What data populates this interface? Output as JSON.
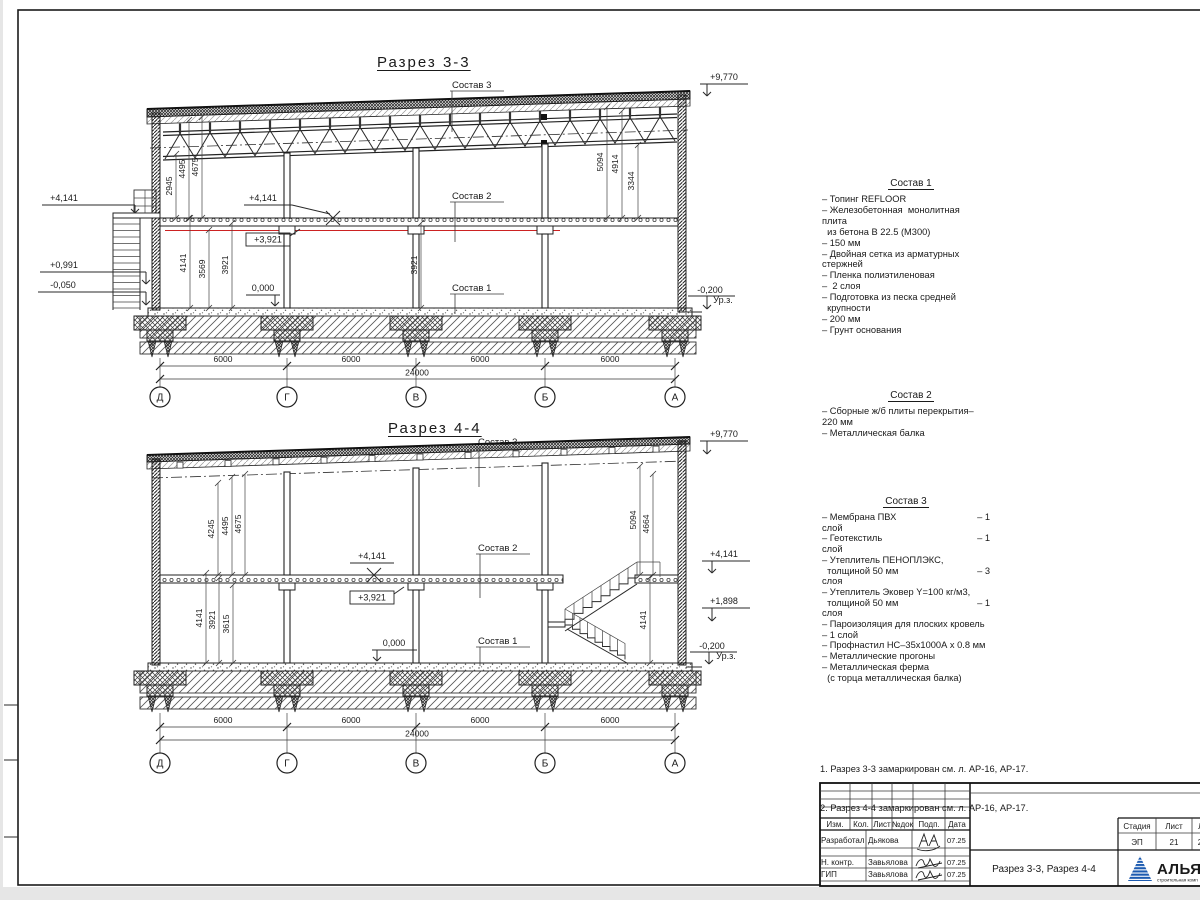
{
  "page": {
    "canvas_bg": "#e6e6e6",
    "sheet_bg": "#ffffff",
    "line_color": "#2a2a2a",
    "red_line_color": "#cc2222",
    "logo_blue": "#1d5bb0",
    "logo_text_blue": "#16357f",
    "logo_red": "#cf3a3a"
  },
  "s33": {
    "title": "Разрез 3-3",
    "sostav3_label": "Состав 3",
    "sostav2_label": "Состав 2",
    "sostav1_label": "Состав 1",
    "elev_roof": "+9,770",
    "elev_platform": "+4,141",
    "elev_stair_mid": "+0,991",
    "elev_stair_base": "-0,050",
    "elev_slab": "+4,141",
    "elev_beam": "+3,921",
    "elev_floor": "0,000",
    "elev_ground": "-0,200",
    "ground_suffix": "Ур.з.",
    "dim_left_up": [
      "2945",
      "4495",
      "4675"
    ],
    "dim_left_low": [
      "4141",
      "3569",
      "3921"
    ],
    "dim_mid": "3921",
    "dim_right": [
      "5094",
      "4914",
      "3344"
    ],
    "dim_span": "6000",
    "dim_total": "24000",
    "axes": [
      "Д",
      "Г",
      "В",
      "Б",
      "А"
    ]
  },
  "s44": {
    "title": "Разрез 4-4",
    "sostav3_label": "Состав 3",
    "sostav2_label": "Состав 2",
    "sostav1_label": "Состав 1",
    "elev_roof": "+9,770",
    "elev_slab": "+4,141",
    "elev_beam": "+3,921",
    "elev_floor": "0,000",
    "elev_slab_right": "+4,141",
    "elev_landing": "+1,898",
    "elev_ground": "-0,200",
    "ground_suffix": "Ур.з.",
    "dim_left_up": [
      "4245",
      "4495",
      "4675"
    ],
    "dim_left_low": [
      "4141",
      "3921",
      "3615"
    ],
    "dim_right": [
      "5094",
      "4664"
    ],
    "dim_stair": "4141",
    "dim_span": "6000",
    "dim_total": "24000",
    "axes": [
      "Д",
      "Г",
      "В",
      "Б",
      "А"
    ]
  },
  "sostav1": {
    "title": "Состав 1",
    "lines": [
      "– Топинг REFLOOR",
      "– Железобетонная  монолитная",
      "плита",
      "  из бетона В 22.5 (М300)",
      "– 150 мм",
      "– Двойная сетка из арматурных",
      "стержней",
      "– Пленка полиэтиленовая",
      "–  2 слоя",
      "– Подготовка из песка средней",
      "  крупности",
      "– 200 мм",
      "– Грунт основания"
    ]
  },
  "sostav2": {
    "title": "Состав 2",
    "lines": [
      "– Сборные ж/б плиты перекрытия–",
      "220 мм",
      "– Металлическая балка"
    ]
  },
  "sostav3": {
    "title": "Состав 3",
    "rows": [
      {
        "t": "– Мембрана ПВХ",
        "r": "– 1"
      },
      {
        "t": "слой",
        "r": ""
      },
      {
        "t": "– Геотекстиль",
        "r": "– 1"
      },
      {
        "t": "слой",
        "r": ""
      },
      {
        "t": "– Утеплитель ПЕНОПЛЭКС,",
        "r": ""
      },
      {
        "t": "  толщиной 50 мм",
        "r": "– 3"
      },
      {
        "t": "слоя",
        "r": ""
      },
      {
        "t": "– Утеплитель Эковер Y=100 кг/м3,",
        "r": ""
      },
      {
        "t": "  толщиной 50 мм",
        "r": "– 1"
      },
      {
        "t": "слоя",
        "r": ""
      },
      {
        "t": "– Пароизоляция для плоских кровель",
        "r": ""
      },
      {
        "t": "– 1 слой",
        "r": ""
      },
      {
        "t": "– Профнастил НС–35х1000А х 0.8 мм",
        "r": ""
      },
      {
        "t": "– Металлические прогоны",
        "r": ""
      },
      {
        "t": "– Металлическая ферма",
        "r": ""
      },
      {
        "t": "  (с торца металлическая балка)",
        "r": ""
      }
    ]
  },
  "notes": {
    "n1": "1. Разрез 3-3 замаркирован см. л. АР-16, АР-17.",
    "n2": "2. Разрез 4-4 замаркирован см. л. АР-16, АР-17."
  },
  "tb": {
    "headers": [
      "Изм.",
      "Кол.",
      "Лист",
      "№док",
      "Подп.",
      "Дата"
    ],
    "rows": [
      {
        "role": "Разработал",
        "name": "Дьякова",
        "date": "07.25"
      },
      {
        "role": "Н. контр.",
        "name": "Завьялова",
        "date": "07.25"
      },
      {
        "role": "ГИП",
        "name": "Завьялова",
        "date": "07.25"
      }
    ],
    "stage_header": "Стадия",
    "sheet_header": "Лист",
    "sheets_header": "Лис",
    "stage": "ЭП",
    "sheet": "21",
    "sheets": "2",
    "doc_title": "Разрез 3-3, Разрез 4-4",
    "logo": "АЛЬЯН",
    "logo_sub": "строительная комп"
  }
}
